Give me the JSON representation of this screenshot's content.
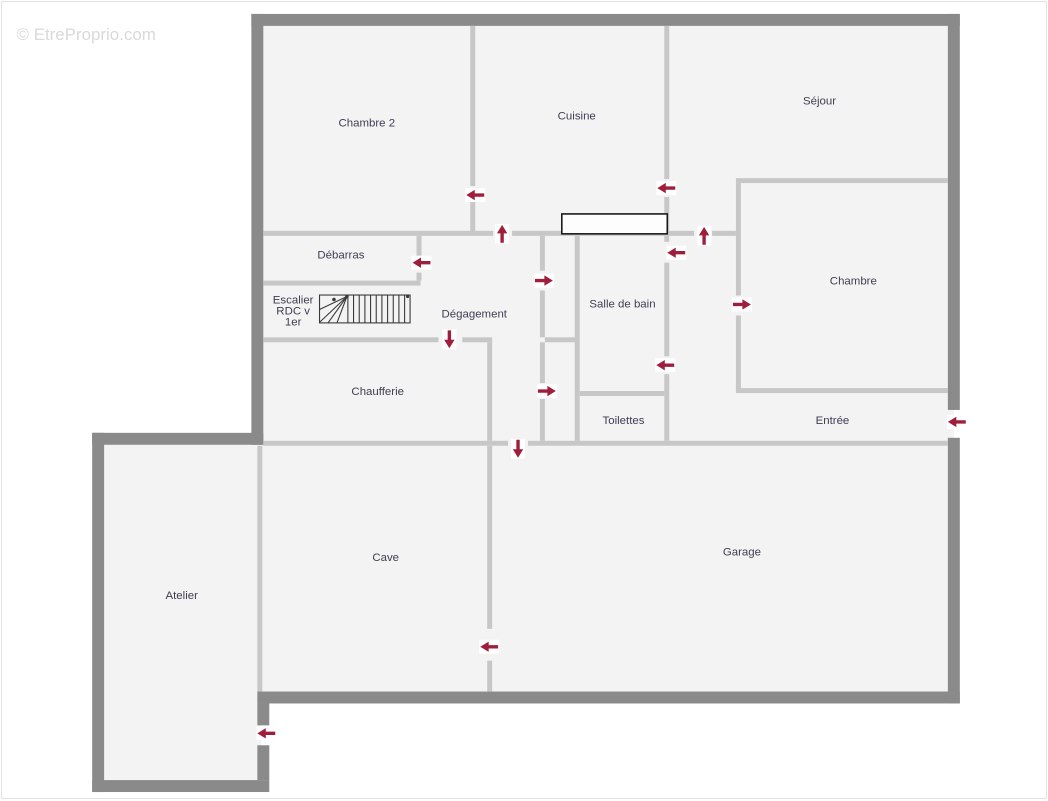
{
  "watermark": "© EtreProprio.com",
  "colors": {
    "outer_wall": "#8a8a8a",
    "inner_wall": "#c7c7c7",
    "room_fill": "#f3f3f4",
    "arrow": "#9e1e3c",
    "label": "#3e3e4f",
    "watermark": "#d9d9d9",
    "counter_stroke": "#1a1a1a"
  },
  "rooms": {
    "chambre2": "Chambre 2",
    "cuisine": "Cuisine",
    "sejour": "Séjour",
    "debarras": "Débarras",
    "degagement": "Dégagement",
    "salle_de_bain": "Salle de bain",
    "chambre": "Chambre",
    "chaufferie": "Chaufferie",
    "toilettes": "Toilettes",
    "entree": "Entrée",
    "cave": "Cave",
    "garage": "Garage",
    "atelier": "Atelier"
  },
  "stairs_label": {
    "line1": "Escalier",
    "line2": "RDC v",
    "line3": "1er"
  },
  "door_arrows": [
    {
      "x": 466,
      "y": 194,
      "dir": "left"
    },
    {
      "x": 658,
      "y": 187,
      "dir": "left"
    },
    {
      "x": 502,
      "y": 224,
      "dir": "up"
    },
    {
      "x": 705,
      "y": 226,
      "dir": "up"
    },
    {
      "x": 412,
      "y": 262,
      "dir": "left"
    },
    {
      "x": 553,
      "y": 280,
      "dir": "right"
    },
    {
      "x": 668,
      "y": 252,
      "dir": "left"
    },
    {
      "x": 752,
      "y": 304,
      "dir": "right"
    },
    {
      "x": 449,
      "y": 348,
      "dir": "down"
    },
    {
      "x": 657,
      "y": 365,
      "dir": "left"
    },
    {
      "x": 556,
      "y": 391,
      "dir": "right"
    },
    {
      "x": 518,
      "y": 458,
      "dir": "down"
    },
    {
      "x": 950,
      "y": 422,
      "dir": "left"
    },
    {
      "x": 480,
      "y": 648,
      "dir": "left"
    },
    {
      "x": 256,
      "y": 735,
      "dir": "left"
    }
  ]
}
